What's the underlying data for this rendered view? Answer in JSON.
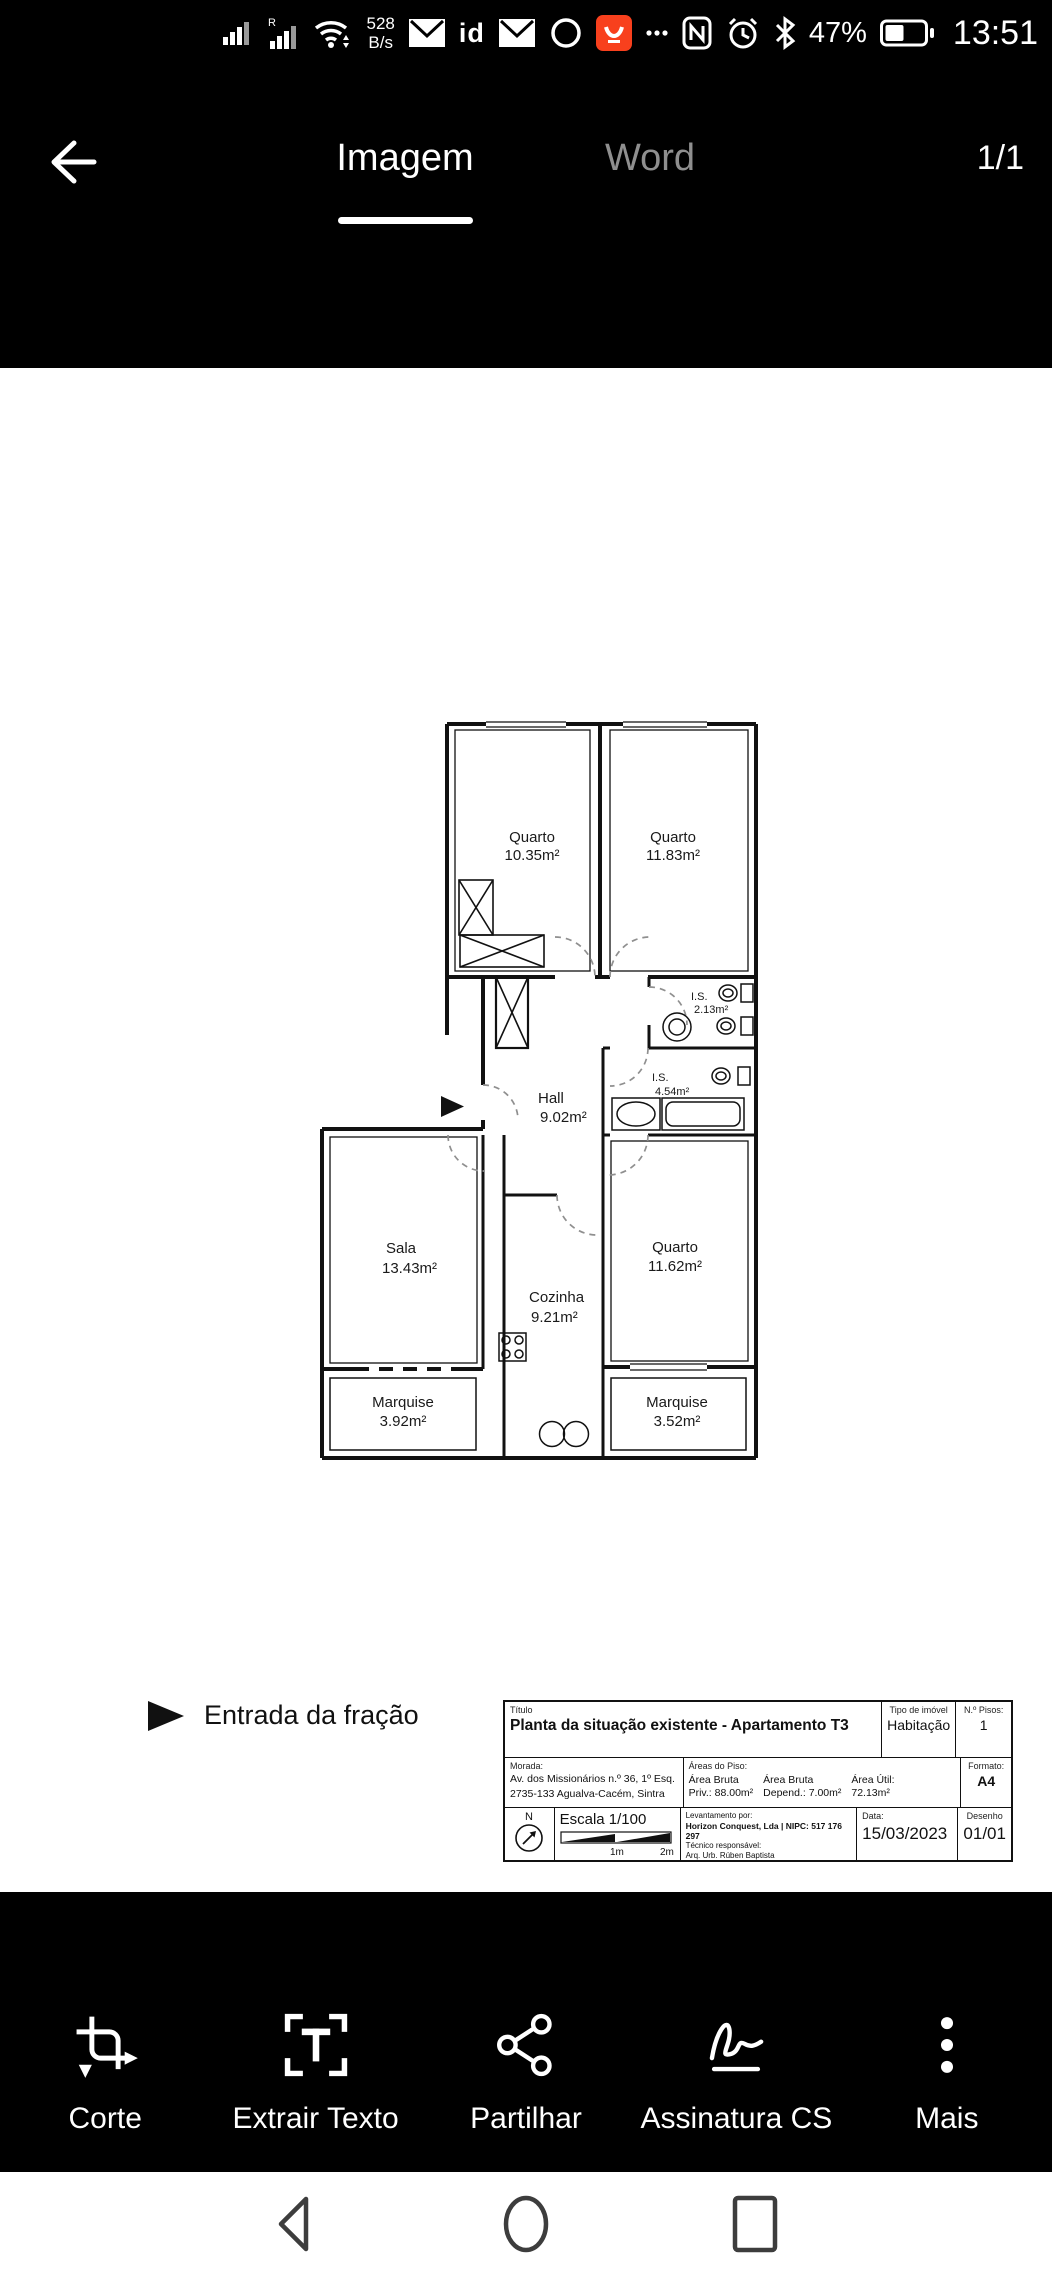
{
  "status_bar": {
    "roaming_indicator": "R",
    "network_speed_line1": "528",
    "network_speed_line2": "B/s",
    "id_icon_text": "id",
    "battery_percent": "47%",
    "time": "13:51"
  },
  "app_bar": {
    "tab_imagem": "Imagem",
    "tab_word": "Word",
    "page_indicator": "1/1"
  },
  "floor_plan": {
    "rooms": {
      "quarto1": {
        "name": "Quarto",
        "area": "10.35m²"
      },
      "quarto2": {
        "name": "Quarto",
        "area": "11.83m²"
      },
      "is1": {
        "name": "I.S.",
        "area": "2.13m²"
      },
      "is2": {
        "name": "I.S.",
        "area": "4.54m²"
      },
      "hall": {
        "name": "Hall",
        "area": "9.02m²"
      },
      "sala": {
        "name": "Sala",
        "area": "13.43m²"
      },
      "cozinha": {
        "name": "Cozinha",
        "area": "9.21m²"
      },
      "quarto3": {
        "name": "Quarto",
        "area": "11.62m²"
      },
      "marquise1": {
        "name": "Marquise",
        "area": "3.92m²"
      },
      "marquise2": {
        "name": "Marquise",
        "area": "3.52m²"
      }
    },
    "legend": {
      "entrance": "Entrada da fração"
    },
    "title_block": {
      "titulo_label": "Título",
      "titulo": "Planta da situação existente - Apartamento T3",
      "tipo_label": "Tipo de imóvel",
      "tipo": "Habitação",
      "pisos_label": "N.º Pisos:",
      "pisos": "1",
      "morada_label": "Morada:",
      "morada1": "Av. dos Missionários n.º 36, 1º Esq.",
      "morada2": "2735-133 Agualva-Cacém, Sintra",
      "areas_label": "Áreas do Piso:",
      "ab1_l1": "Área Bruta",
      "ab1_l2": "Priv.: 88.00m²",
      "ab2_l1": "Área Bruta",
      "ab2_l2": "Depend.: 7.00m²",
      "au_l1": "Área Útil:",
      "au_l2": "72.13m²",
      "formato_label": "Formato:",
      "formato": "A4",
      "north": "N",
      "escala": "Escala 1/100",
      "scale1": "1m",
      "scale2": "2m",
      "lev_label": "Levantamento por:",
      "lev_value": "Horizon Conquest, Lda | NIPC: 517 176 297",
      "tec_label": "Técnico responsável:",
      "tec_value": "Arq. Urb. Rúben Baptista",
      "data_label": "Data:",
      "data_value": "15/03/2023",
      "desenho_label": "Desenho",
      "desenho_value": "01/01"
    }
  },
  "toolbar": {
    "items": [
      {
        "label": "Corte"
      },
      {
        "label": "Extrair Texto"
      },
      {
        "label": "Partilhar"
      },
      {
        "label": "Assinatura CS"
      },
      {
        "label": "Mais"
      }
    ]
  }
}
